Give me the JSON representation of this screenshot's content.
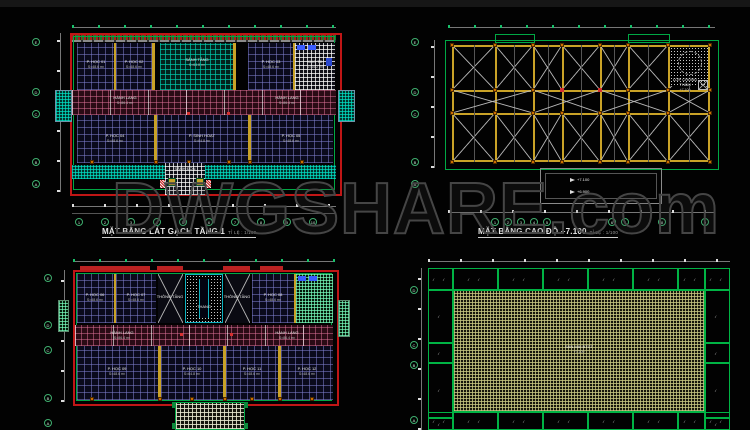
{
  "watermark": {
    "text": "DWGSHARE",
    "suffix": ".com"
  },
  "axes": {
    "letters": [
      "E",
      "D",
      "C",
      "B",
      "A"
    ],
    "numbers": [
      "1",
      "2",
      "3",
      "4",
      "5",
      "6",
      "7",
      "8",
      "9",
      "10",
      "11"
    ]
  },
  "panels": {
    "tl": {
      "title": "MẶT BẰNG LÁT GẠCH TẦNG 1",
      "scale": "TỈ LỆ : 1/100",
      "corridor": {
        "name": "HÀNH LANG",
        "area": "S=86.4 m²"
      },
      "entrance": "SẢNH ĐÓN",
      "rooms": [
        {
          "name": "P. HỌC 01",
          "area": "S=48.6 m²"
        },
        {
          "name": "P. HỌC 02",
          "area": "S=48.6 m²"
        },
        {
          "name": "SẢNH TẦNG",
          "area": "S=64.8 m²"
        },
        {
          "name": "P. HỌC 03",
          "area": "S=48.6 m²"
        },
        {
          "name": "KHO TB",
          "area": "S=16.2 m²"
        },
        {
          "name": "P. HỌC 04",
          "area": "S=48.6 m²"
        },
        {
          "name": "P. SINH HOẠT",
          "area": "S=64.8 m²"
        },
        {
          "name": "P. HỌC 05",
          "area": "S=48.6 m²"
        }
      ]
    },
    "tr": {
      "title": "MẶT BẰNG CAO ĐỘ +7.100",
      "scale": "TỈ LỆ : 1/100",
      "levels": [
        "+7.100",
        "+6.900"
      ],
      "note": [
        "LỚP CHỐNG THẤM",
        "+7.100"
      ]
    },
    "bl": {
      "corridor": {
        "name": "HÀNH LANG",
        "area": "S=86.4 m²"
      },
      "stair": {
        "name": "THANG",
        "area": ""
      },
      "rooms": [
        {
          "name": "P. HỌC 06",
          "area": "S=48.6 m²"
        },
        {
          "name": "P. HỌC 07",
          "area": "S=48.6 m²"
        },
        {
          "name": "THÔNG TẦNG",
          "area": ""
        },
        {
          "name": "THÔNG TẦNG",
          "area": ""
        },
        {
          "name": "P. HỌC 08",
          "area": "S=48.6 m²"
        },
        {
          "name": "P. HỌC 09",
          "area": "S=48.6 m²"
        },
        {
          "name": "P. HỌC 10",
          "area": "S=64.8 m²"
        },
        {
          "name": "P. HỌC 11",
          "area": "S=48.6 m²"
        },
        {
          "name": "P. HỌC 12",
          "area": "S=48.6 m²"
        }
      ]
    },
    "br": {
      "center_label": [
        "SÀN MÁI BTCT",
        "+7.100"
      ]
    }
  }
}
